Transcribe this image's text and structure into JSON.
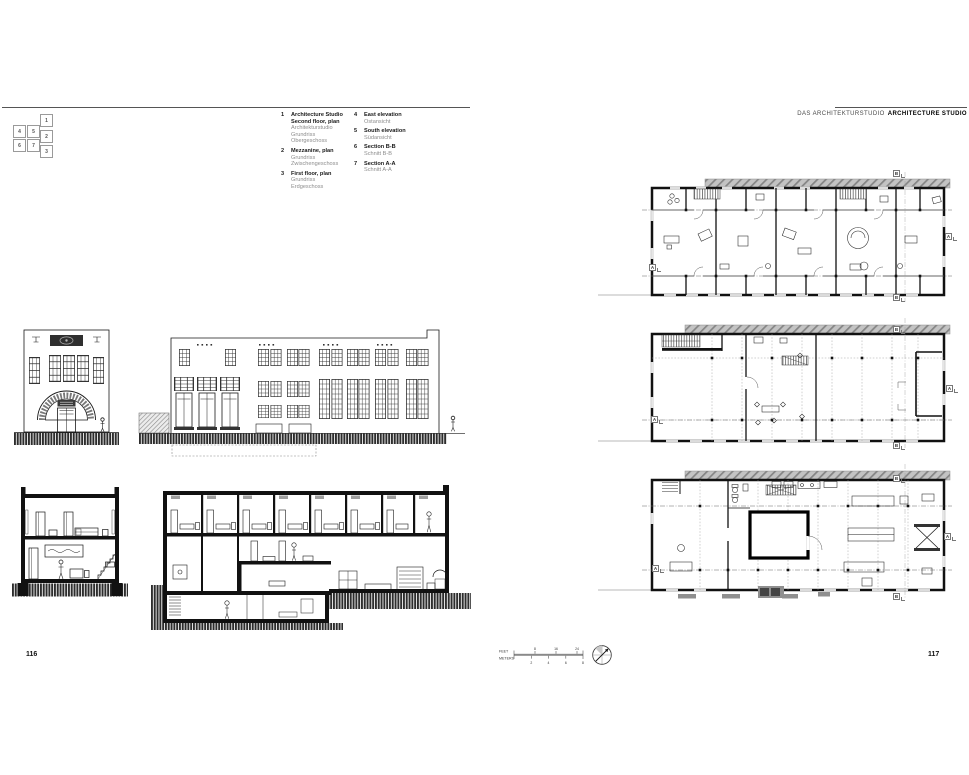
{
  "header_right": {
    "de": "DAS ARCHITEKTURSTUDIO",
    "en": "ARCHITECTURE STUDIO"
  },
  "pages": {
    "left_number": "116",
    "right_number": "117"
  },
  "key_map": {
    "boxes": [
      "1",
      "2",
      "3",
      "4",
      "5",
      "6",
      "7"
    ]
  },
  "legend": {
    "col1": [
      {
        "num": "1",
        "title": "Architecture Studio\nSecond floor, plan",
        "subtitle": "Architekturstudio\nGrundriss\nObergeschoss"
      },
      {
        "num": "2",
        "title": "Mezzanine, plan",
        "subtitle": "Grundriss\nZwischengeschoss"
      },
      {
        "num": "3",
        "title": "First floor, plan",
        "subtitle": "Grundriss\nErdgeschoss"
      }
    ],
    "col2": [
      {
        "num": "4",
        "title": "East elevation",
        "subtitle": "Ostansicht"
      },
      {
        "num": "5",
        "title": "South elevation",
        "subtitle": "Südansicht"
      },
      {
        "num": "6",
        "title": "Section B-B",
        "subtitle": "Schnitt B-B"
      },
      {
        "num": "7",
        "title": "Section A-A",
        "subtitle": "Schnitt A-A"
      }
    ]
  },
  "section_markers": {
    "a": "A",
    "b": "B"
  },
  "scale_bar": {
    "feet_label": "FEET",
    "meters_label": "METERS",
    "feet_ticks": [
      "8",
      "16",
      "24"
    ],
    "meters_ticks": [
      "2",
      "4",
      "6",
      "8"
    ]
  },
  "ink_color": "#1a1a1a"
}
